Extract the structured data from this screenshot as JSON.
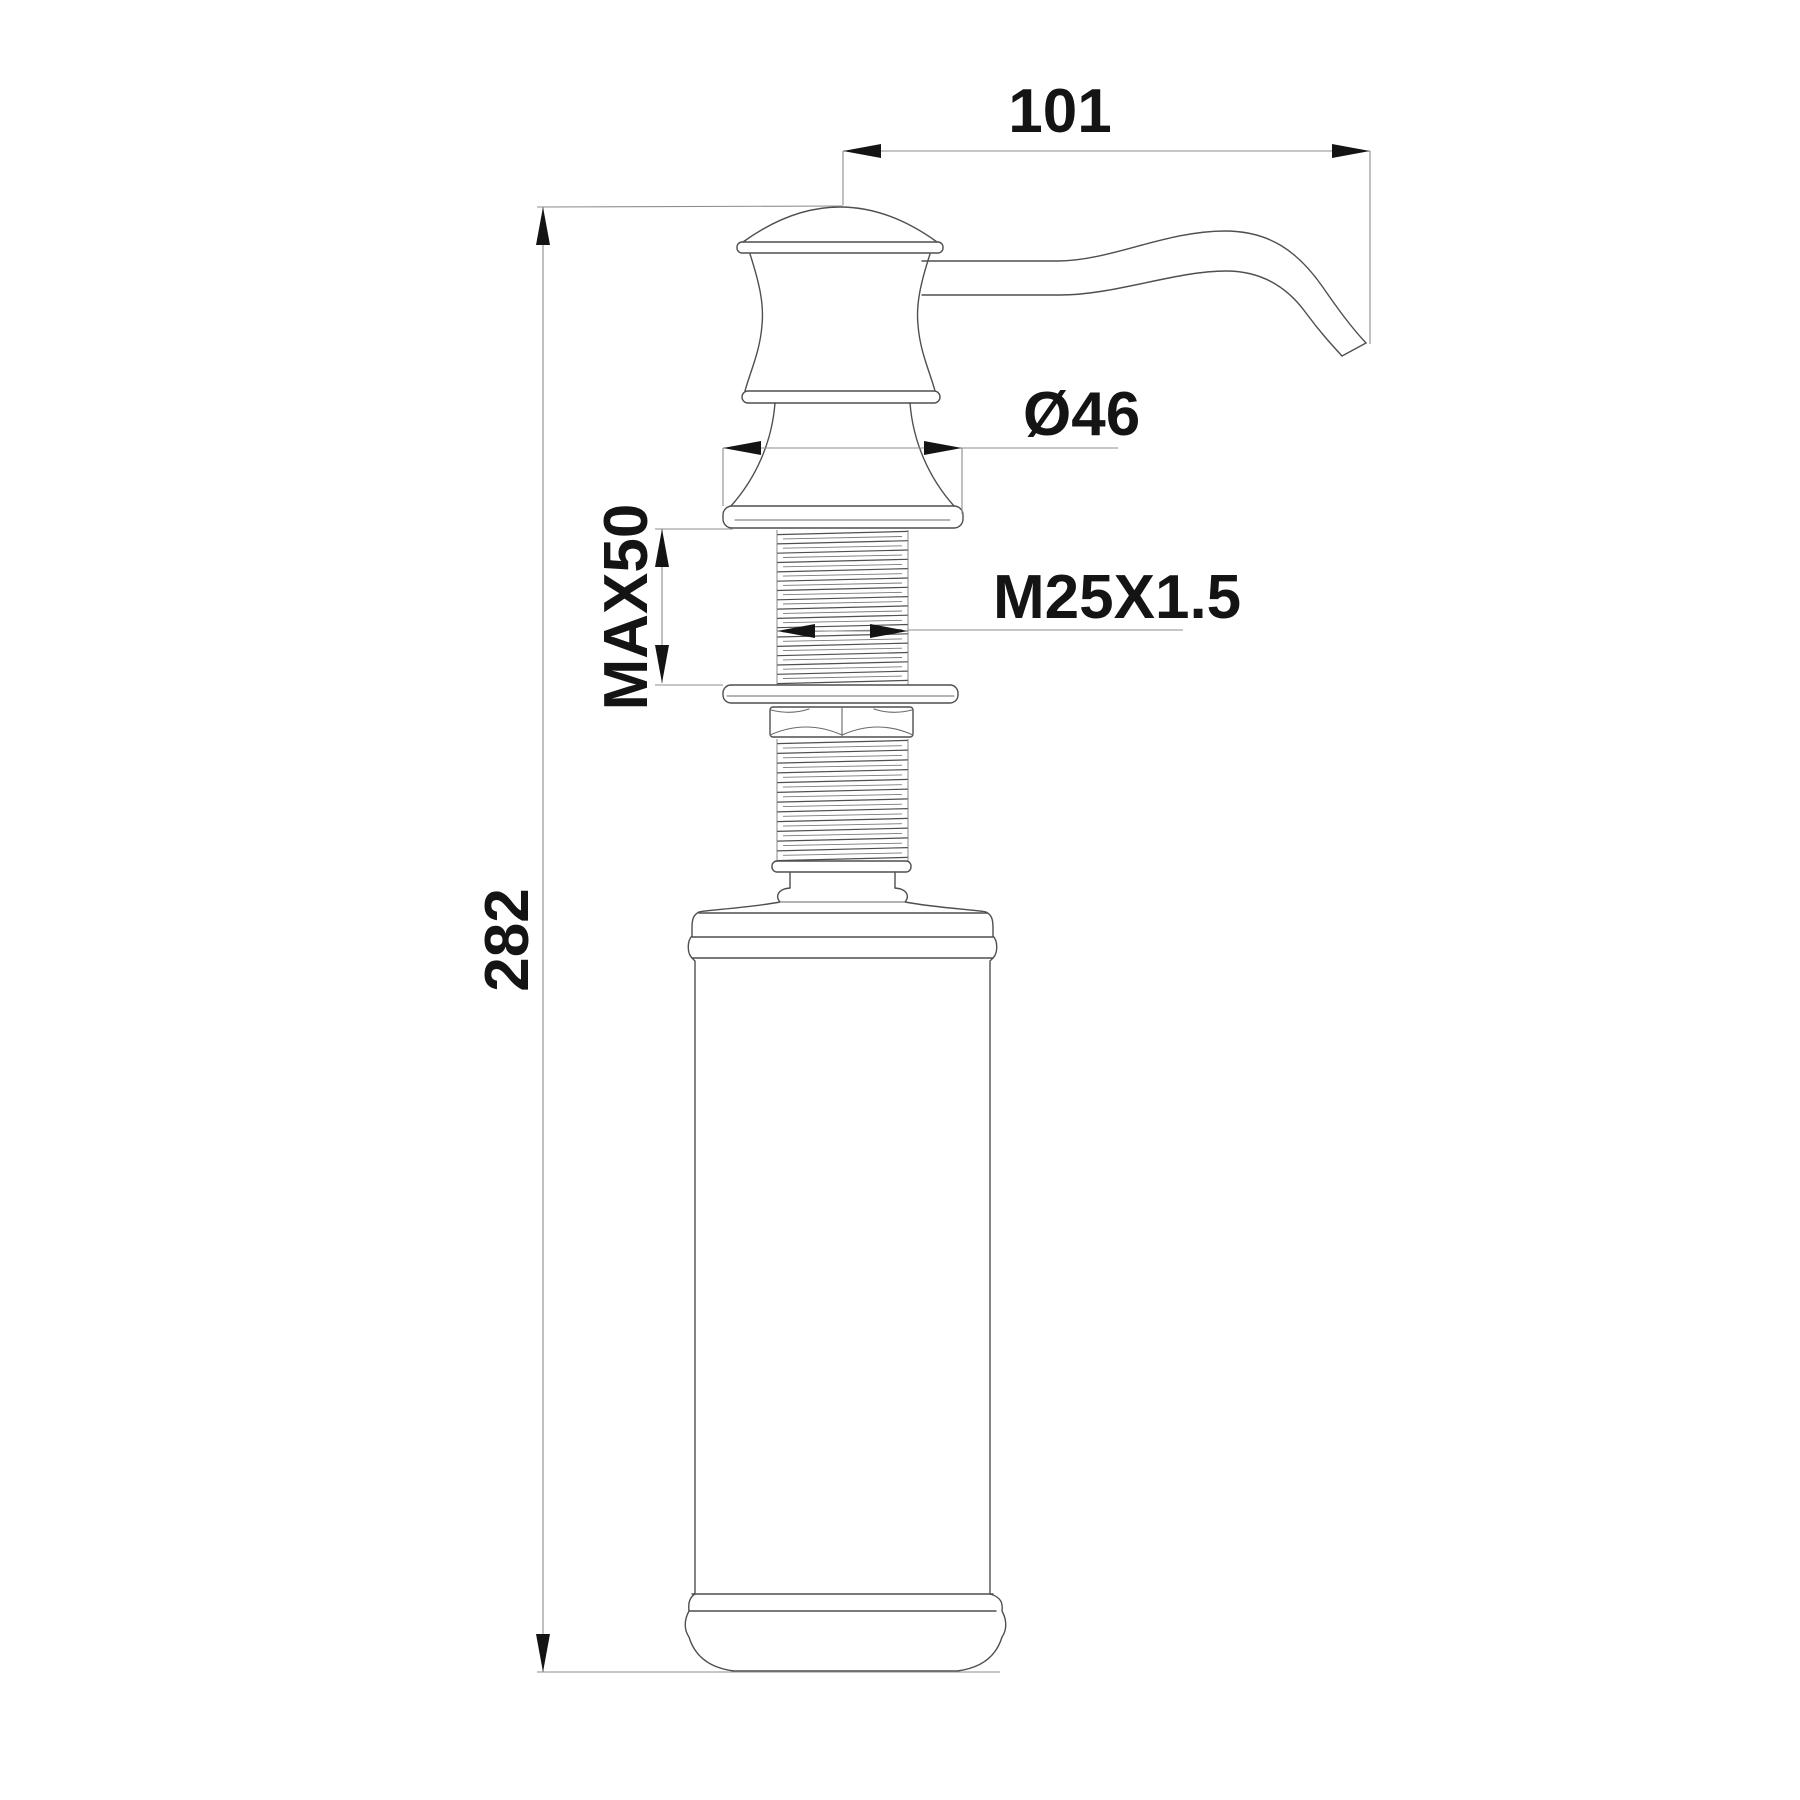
{
  "drawing": {
    "kind": "technical-dimension-drawing",
    "subject": "deck-mounted soap dispenser pump with bottle",
    "dimensions": {
      "spout_reach": "101",
      "flange_diameter": "Ø46",
      "max_deck_thickness": "MAX50",
      "thread_spec": "M25X1.5",
      "overall_height": "282"
    },
    "colors": {
      "background": "#ffffff",
      "part_outline": "#4f4f4f",
      "dimension_line": "#8d8d8d",
      "dimension_text": "#141414"
    }
  }
}
